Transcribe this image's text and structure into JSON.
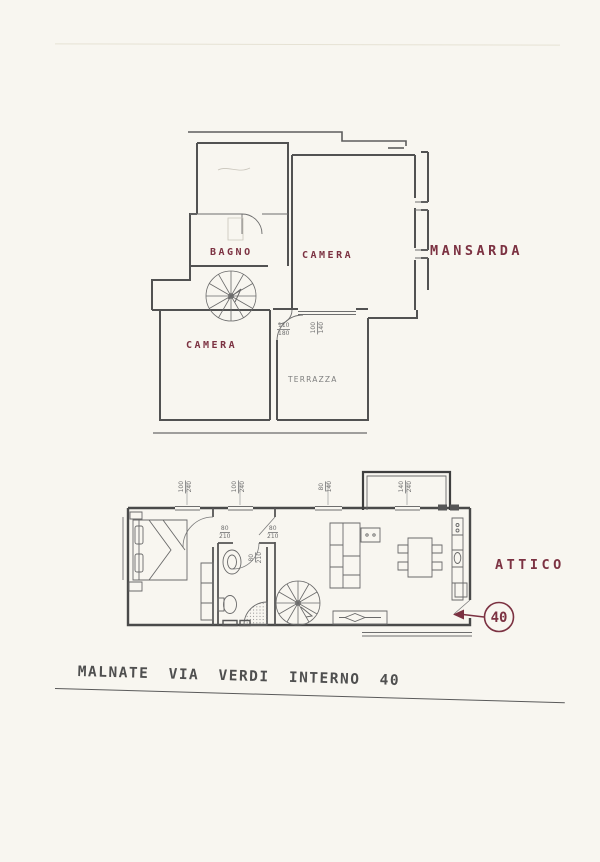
{
  "caption": "MALNATE VIA VERDI INTERNO 40",
  "mansarda": {
    "label": "MANSARDA",
    "rooms": {
      "bagno": "BAGNO",
      "camera_top": "CAMERA",
      "camera_bottom": "CAMERA",
      "terrazza": "TERRAZZA"
    },
    "dims": {
      "door": {
        "w": "110",
        "h": "180"
      },
      "window": {
        "w": "100",
        "h": "140"
      }
    }
  },
  "attico": {
    "label": "ATTICO",
    "unit_number": "40",
    "dims": {
      "win1": {
        "w": "100",
        "h": "240"
      },
      "win2": {
        "w": "100",
        "h": "240"
      },
      "win3": {
        "w": "80",
        "h": "140"
      },
      "win4": {
        "w": "140",
        "h": "240"
      },
      "door1": {
        "w": "80",
        "h": "210"
      },
      "door2": {
        "w": "80",
        "h": "210"
      },
      "door3": {
        "w": "80",
        "h": "210"
      }
    }
  },
  "colors": {
    "paper": "#f8f6f0",
    "wall": "#4e4e4e",
    "line": "#6a6a6a",
    "accent": "#7c3242",
    "dim_text": "#6f6f6f",
    "pencil": "#4f4f4f"
  }
}
